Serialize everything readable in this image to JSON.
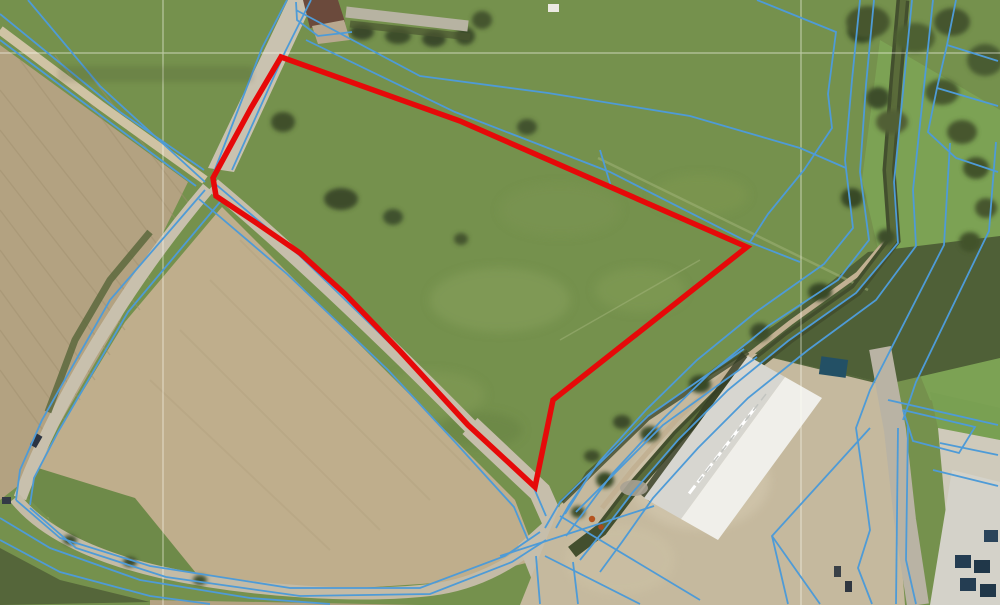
{
  "map": {
    "type": "aerial-cadastral-view",
    "colors": {
      "highlight": "#e60909",
      "cadastral": "#4e9bd7",
      "grid": "#fffff5"
    },
    "highlight_parcel": {
      "stroke_width": 5.5,
      "points": "281,57 460,121 747,247 553,400 535,487 468,425 400,351 345,294 300,253 255,222 216,196 213,178 251,108"
    },
    "grid": {
      "vertical_x": [
        163,
        801
      ],
      "horizontal_y": [
        53
      ]
    },
    "cadastral_lines": [
      "0,14 120,112 204,170",
      "0,40 80,100 196,186",
      "28,0 100,86 205,182",
      "287,0 262,48 214,172",
      "311,0 285,52 232,170",
      "296,2 297,20 318,36 352,32",
      "296,10 420,76 548,93 690,116 800,148 846,168",
      "306,40 455,112 610,172 744,240 800,262",
      "600,150 612,190",
      "213,182 300,256 400,353 469,425 534,488 546,516",
      "199,199 287,274 388,370 455,442 514,507 528,540",
      "205,190 110,300 42,420 20,470 16,500",
      "220,202 128,312 58,432 34,478 30,505",
      "16,500 60,538 150,566 290,588 420,588 505,556 540,532",
      "30,508 76,548 166,577 300,596 430,594 512,562 546,540",
      "0,518 50,548 140,580 250,598 330,604",
      "0,540 60,572 150,596 210,604",
      "860,0 852,80 845,160 853,228 824,264 756,312 697,360 646,410 599,462 569,505 556,528",
      "874,0 866,85 860,172 869,240 838,280 768,326 710,373 660,422 613,473 581,516 566,536",
      "912,0 903,92 894,182 898,243 856,293 788,341 728,390 678,440 633,492 601,534 580,560",
      "933,0 923,96 913,190 916,246 876,300 808,350 748,398 698,448 653,498 622,542 600,572",
      "757,0 836,32 828,94 832,128 804,170 768,214 750,242",
      "956,0 947,45 998,61",
      "947,45 937,88 998,106",
      "937,88 928,132 956,158 998,172",
      "950,143 944,245 870,390 856,428 862,470",
      "996,142 989,231 916,382 903,420",
      "744,349 648,416 560,502 545,528",
      "757,357 663,425 576,512",
      "870,428 772,536 788,604",
      "772,536 820,604",
      "888,400 998,425",
      "903,410 975,427 959,453 913,441 903,410",
      "862,470 870,530 858,568 872,604",
      "898,428 896,604",
      "908,426 906,560 916,604",
      "940,443 998,455",
      "933,470 998,486",
      "500,556 654,506",
      "560,516 700,600",
      "545,556 640,604",
      "536,556 540,604",
      "573,562 578,604",
      "590,474 565,514"
    ]
  }
}
